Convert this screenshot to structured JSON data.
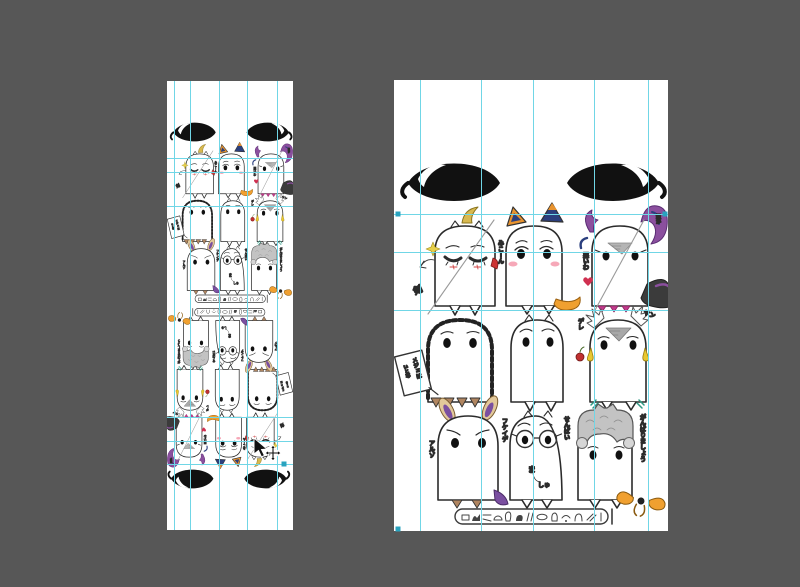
{
  "colors": {
    "workspace_background": "#575757",
    "guide": "#70d6e6",
    "guide_handle": "#29a3bf",
    "artboard": "#ffffff",
    "ink": "#2b2b2b",
    "accents": {
      "ahoge_yellow": "#d8b94f",
      "tail_orange": "#f0a030",
      "ear_navy": "#2b3f7e",
      "tentacle_purple": "#8b4f9e",
      "blush_pink": "#f6a8b8",
      "apple_red": "#c03030",
      "claw_teal": "#2f9a84",
      "fringe_brown": "#b08560",
      "crown_gray": "#c3c3c3"
    }
  },
  "artboards": {
    "left": {
      "description": "small artboard, two sticker sheets stacked, lower one rotated 180",
      "guides": {
        "vertical": [
          7,
          23,
          52,
          80,
          110
        ],
        "horizontal": [
          77,
          91,
          125,
          336,
          360,
          383
        ]
      },
      "handles": [
        {
          "x": 117,
          "y": 383
        }
      ]
    },
    "right": {
      "description": "large artboard, single sticker sheet",
      "guides": {
        "vertical": [
          26,
          87,
          139,
          200,
          254
        ],
        "horizontal": [
          134,
          172,
          230
        ]
      },
      "handles": [
        {
          "x": 4,
          "y": 134
        },
        {
          "x": 271,
          "y": 134
        },
        {
          "x": 4,
          "y": 449
        }
      ]
    }
  },
  "sheet": {
    "description": "hand-drawn Medjed-style ghost character sticker sheet, two big eyes on top, 3x3 grid of ghosts, hieroglyph cartouche at bottom",
    "row1": {
      "a": {
        "name": "sleepy ghost with ahoge",
        "label": "剣"
      },
      "b": {
        "name": "cat-ear ghost",
        "label": "みこーん"
      },
      "c": {
        "name": "tentacle ghost",
        "label": "悪いわ",
        "label2": "姐か"
      }
    },
    "row2": {
      "d": {
        "name": "hooded ghost with sign",
        "sign1": "メジェは",
        "sign2": "いと尊"
      },
      "e": {
        "name": "plain ghost"
      },
      "f": {
        "name": "winged yandere ghost",
        "label_top": "ヤン",
        "label_left": "デレ"
      }
    },
    "row3": {
      "g": {
        "name": "droopy-ear ghost",
        "label_left": "アルゾ",
        "label_right": "フケイデ"
      },
      "h": {
        "name": "glasses ghost",
        "label_right": "せんぱい",
        "mouth1": "ま",
        "mouth2": "しゅ"
      },
      "i": {
        "name": "crowned ghost",
        "label": "がんばりましょう"
      }
    },
    "cartouche": {
      "content": "hieroglyphs",
      "glyph_count": 13
    }
  },
  "cursor": {
    "type": "move-arrow-cursor",
    "x": 253,
    "y": 438
  }
}
